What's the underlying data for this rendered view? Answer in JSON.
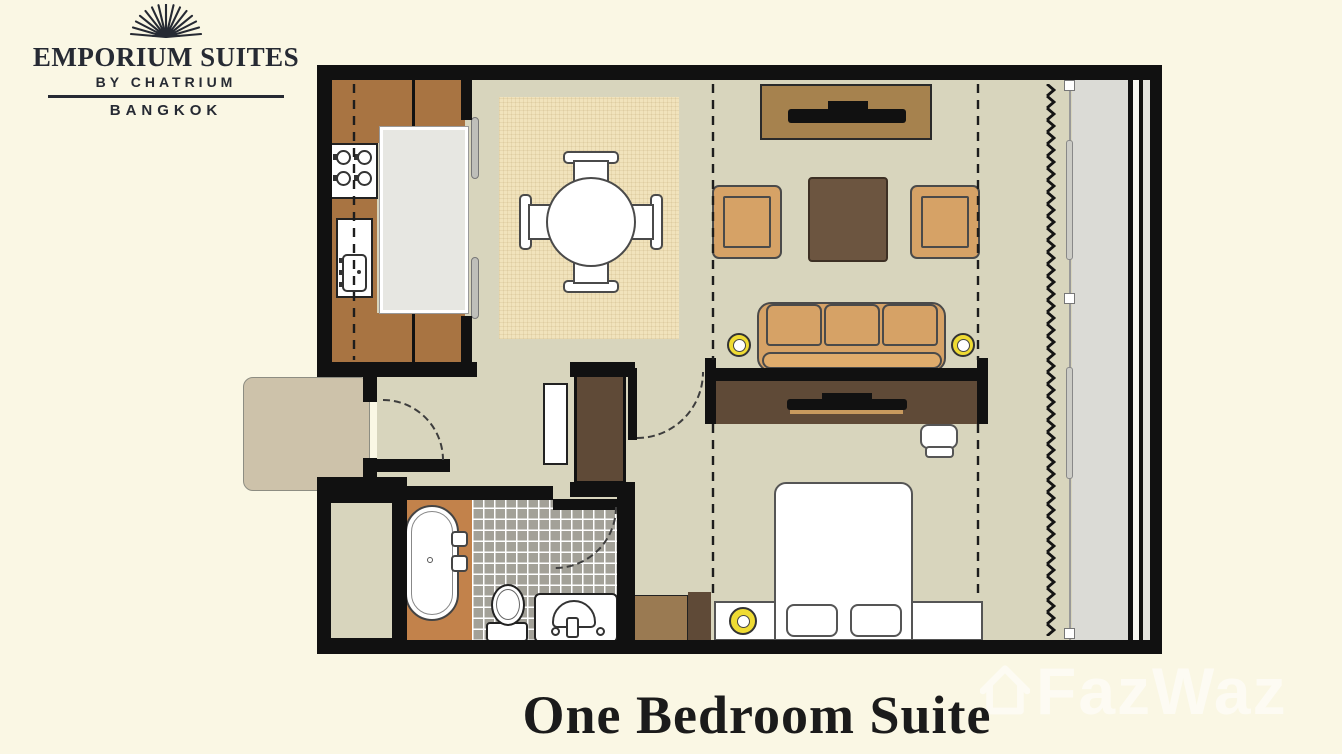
{
  "brand": {
    "logo_icon": "sunburst-icon",
    "name": "EMPORIUM SUITES",
    "byline": "BY CHATRIUM",
    "city": "BANGKOK"
  },
  "plan_title": "One Bedroom Suite",
  "watermark": {
    "icon": "house-icon",
    "text": "FazWaz"
  },
  "palette": {
    "bg": "#FAF7E4",
    "wall": "#111111",
    "floor": "#D8D5BD",
    "rug": "#F1E3BC",
    "brown": "#A87442",
    "island": "#E7E7E2",
    "tan": "#D6A266",
    "tan_light": "#E0AC6C",
    "dkbrown": "#6C5540",
    "console_light": "#A6824E",
    "console_dark": "#5F4A37",
    "bath_floor": "#C2824B",
    "tile": "#A3A198",
    "mat": "#CDC2AA",
    "yellow": "#EFDB33",
    "glass": "#DBDBD6"
  },
  "rooms": [
    "kitchen",
    "dining-area",
    "living-room",
    "bedroom",
    "bathroom",
    "entry-hall",
    "window-balcony"
  ],
  "furniture_icons": [
    "kitchen-counter",
    "cooktop-stove",
    "kitchen-sink",
    "kitchen-island",
    "dining-rug",
    "round-dining-table",
    "dining-chair",
    "tv-console",
    "flat-tv",
    "armchair",
    "coffee-table",
    "sofa",
    "wall-lamp",
    "bedroom-tv-console",
    "desk-chair",
    "double-bed",
    "pillow",
    "headboard",
    "bedside-lamp",
    "wardrobe",
    "closet",
    "entry-mat",
    "bathtub",
    "toilet",
    "vanity-sink",
    "mirror-cabinet",
    "curtain-zigzag",
    "window-glass",
    "door-swing"
  ]
}
